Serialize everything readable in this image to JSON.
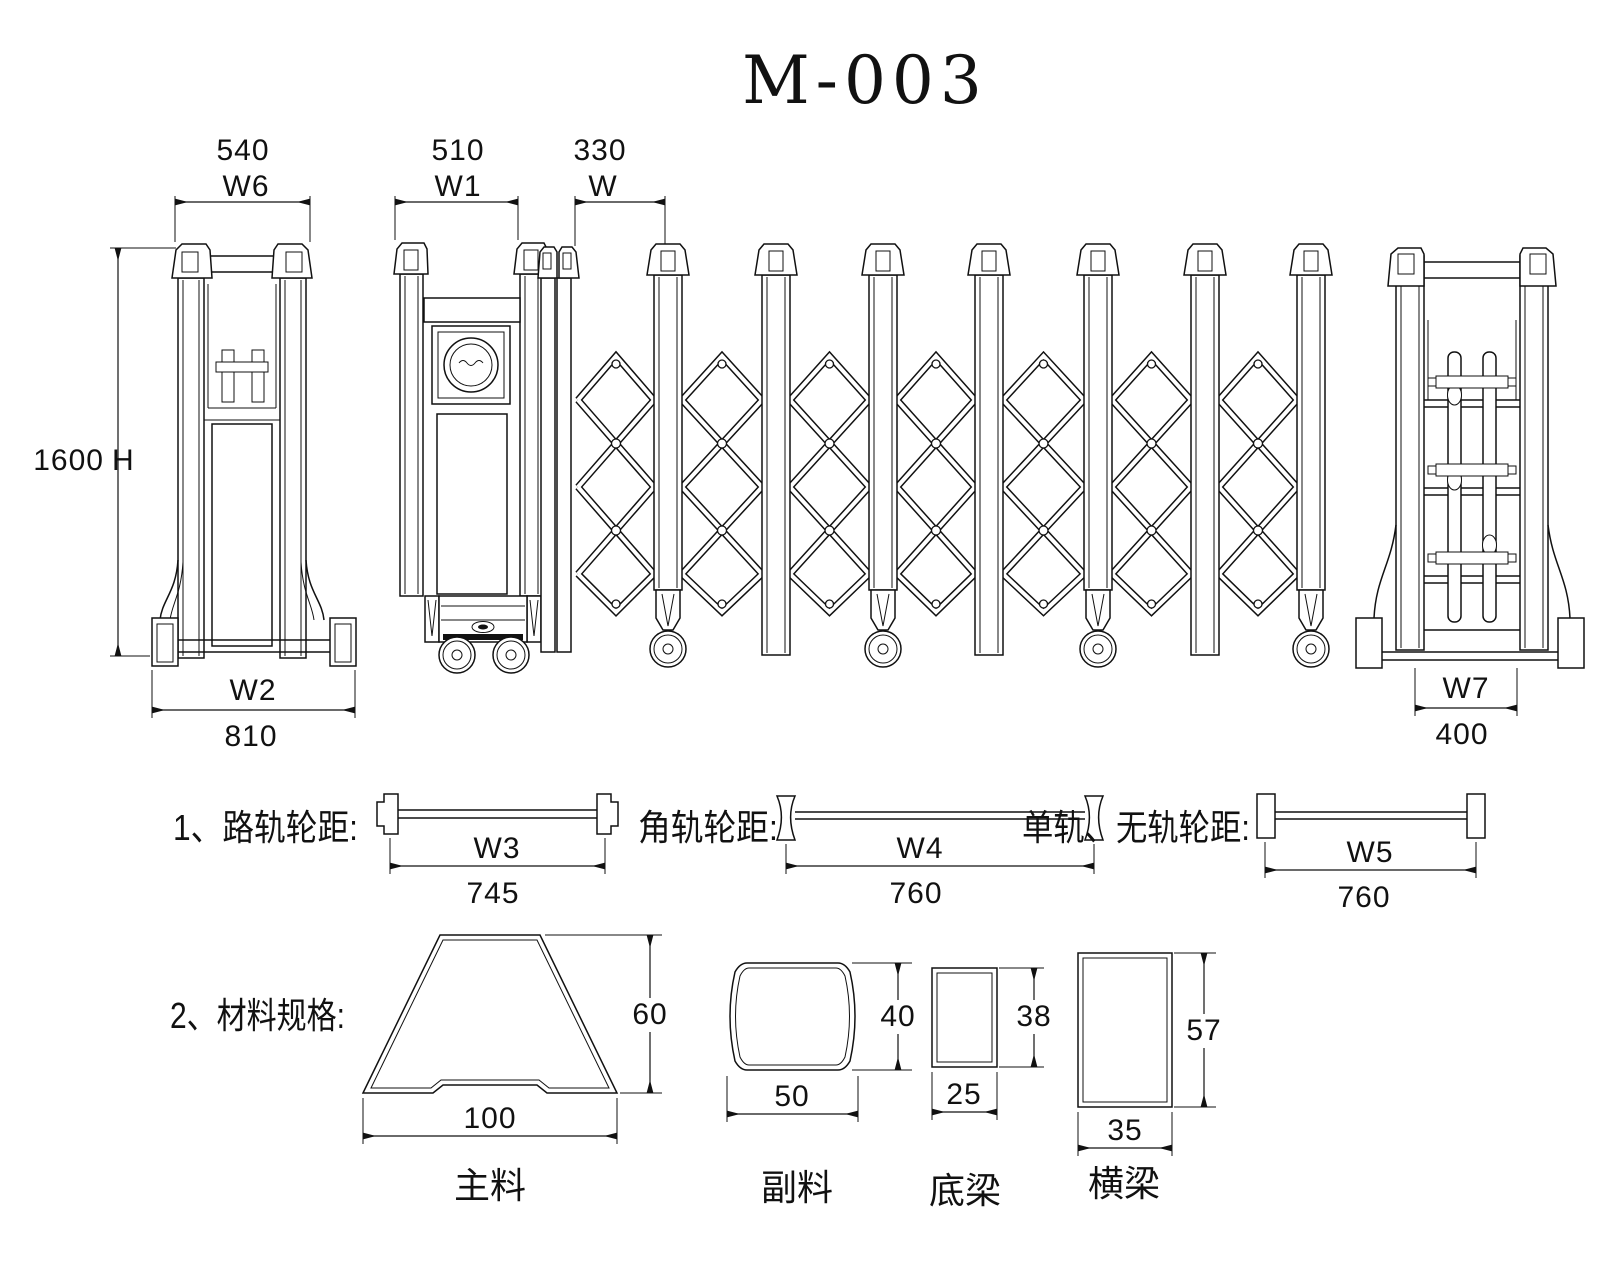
{
  "title": "M-003",
  "line_color": "#111111",
  "top_dims": {
    "left_view_width": {
      "value": "540",
      "label": "W6"
    },
    "gate_panel_width": {
      "value": "510",
      "label": "W1"
    },
    "unit_pitch": {
      "value": "330",
      "label": "W"
    }
  },
  "left_view": {
    "height_value": "1600",
    "height_label": "H",
    "base_label": "W2",
    "base_value": "810"
  },
  "right_view": {
    "base_label": "W7",
    "base_value": "400"
  },
  "wheelbase_section": {
    "items": [
      {
        "label": "1、路轨轮距:",
        "dim_label": "W3",
        "dim_value": "745"
      },
      {
        "label": "角轨轮距:",
        "dim_label": "W4",
        "dim_value": "760"
      },
      {
        "label": "单轨、无轨轮距:",
        "dim_label": "W5",
        "dim_value": "760"
      }
    ]
  },
  "materials_section": {
    "label": "2、材料规格:",
    "profiles": [
      {
        "name": "主料",
        "width": "100",
        "height": "60"
      },
      {
        "name": "副料",
        "width": "50",
        "height": "40"
      },
      {
        "name": "底梁",
        "width": "25",
        "height": "38"
      },
      {
        "name": "横梁",
        "width": "35",
        "height": "57"
      }
    ]
  }
}
